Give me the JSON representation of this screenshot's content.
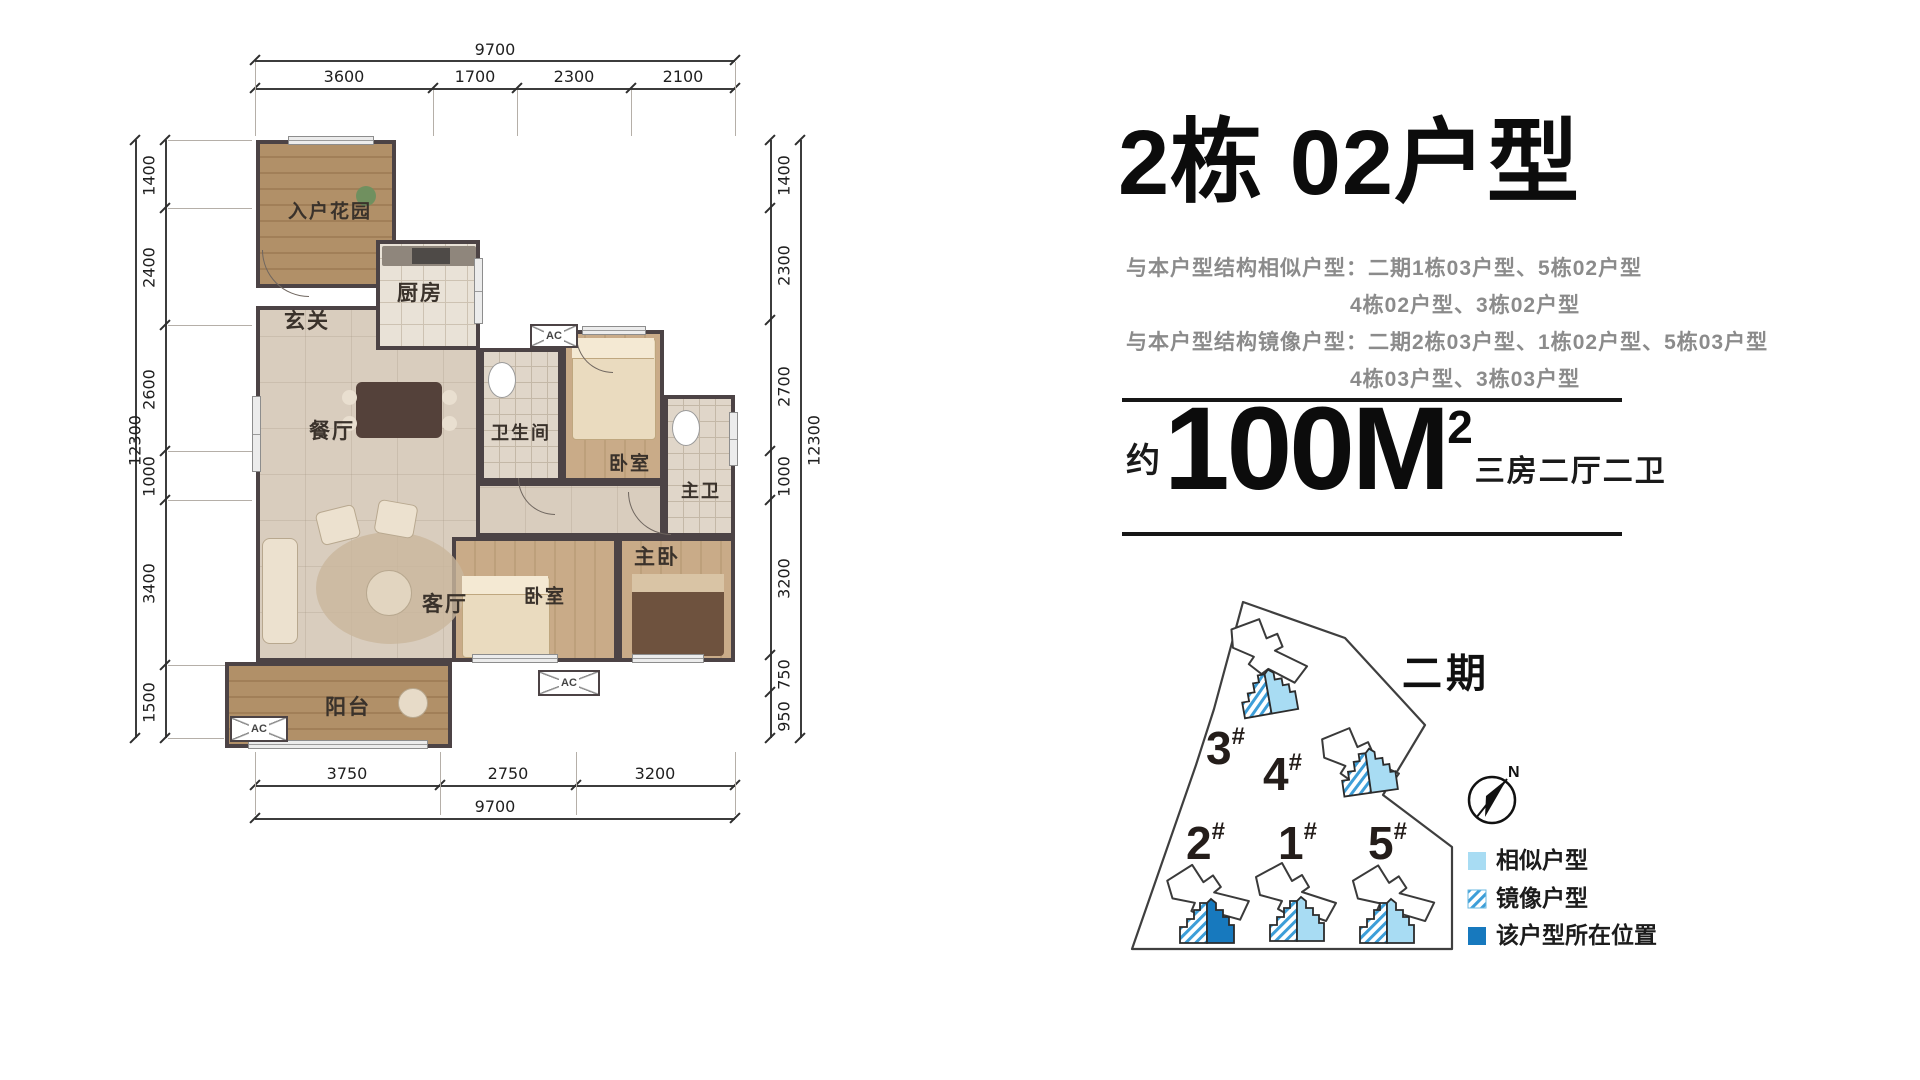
{
  "header": {
    "title": "2栋 02户型",
    "similar_label": "与本户型结构相似户型：",
    "similar_line1": "二期1栋03户型、5栋02户型",
    "similar_line2": "4栋02户型、3栋02户型",
    "mirror_label": "与本户型结构镜像户型：",
    "mirror_line1": "二期2栋03户型、1栋02户型、5栋03户型",
    "mirror_line2": "4栋03户型、3栋03户型",
    "area_prefix": "约",
    "area_value": "100M",
    "area_sup": "2",
    "area_type": "三房二厅二卫"
  },
  "floorplan": {
    "rooms": {
      "entry_garden": "入户花园",
      "foyer": "玄关",
      "kitchen": "厨房",
      "dining": "餐厅",
      "bathroom": "卫生间",
      "bedroom_top": "卧室",
      "master_bath": "主卫",
      "bedroom_mid": "卧室",
      "master_bedroom": "主卧",
      "living": "客厅",
      "balcony": "阳台"
    },
    "ac_label": "AC",
    "dims": {
      "top_overall": "9700",
      "top_segments": [
        "3600",
        "1700",
        "2300",
        "2100"
      ],
      "left_overall": "12300",
      "left_segments": [
        "1400",
        "2400",
        "2600",
        "1000",
        "3400",
        "1500"
      ],
      "right_overall": "12300",
      "right_segments": [
        "1400",
        "2300",
        "2700",
        "1000",
        "3200",
        "750",
        "950"
      ],
      "bottom_segments": [
        "3750",
        "2750",
        "3200"
      ],
      "bottom_overall": "9700"
    }
  },
  "siteplan": {
    "phase_label": "二期",
    "north_label": "N",
    "buildings": [
      {
        "num": "3",
        "sup": "#"
      },
      {
        "num": "4",
        "sup": "#"
      },
      {
        "num": "2",
        "sup": "#"
      },
      {
        "num": "1",
        "sup": "#"
      },
      {
        "num": "5",
        "sup": "#"
      }
    ],
    "legend": [
      {
        "label": "相似户型"
      },
      {
        "label": "镜像户型"
      },
      {
        "label": "该户型所在位置"
      }
    ],
    "colors": {
      "similar": "#a8dcf3",
      "mirror_stripe": "#3d9ed8",
      "current": "#1779be"
    }
  }
}
